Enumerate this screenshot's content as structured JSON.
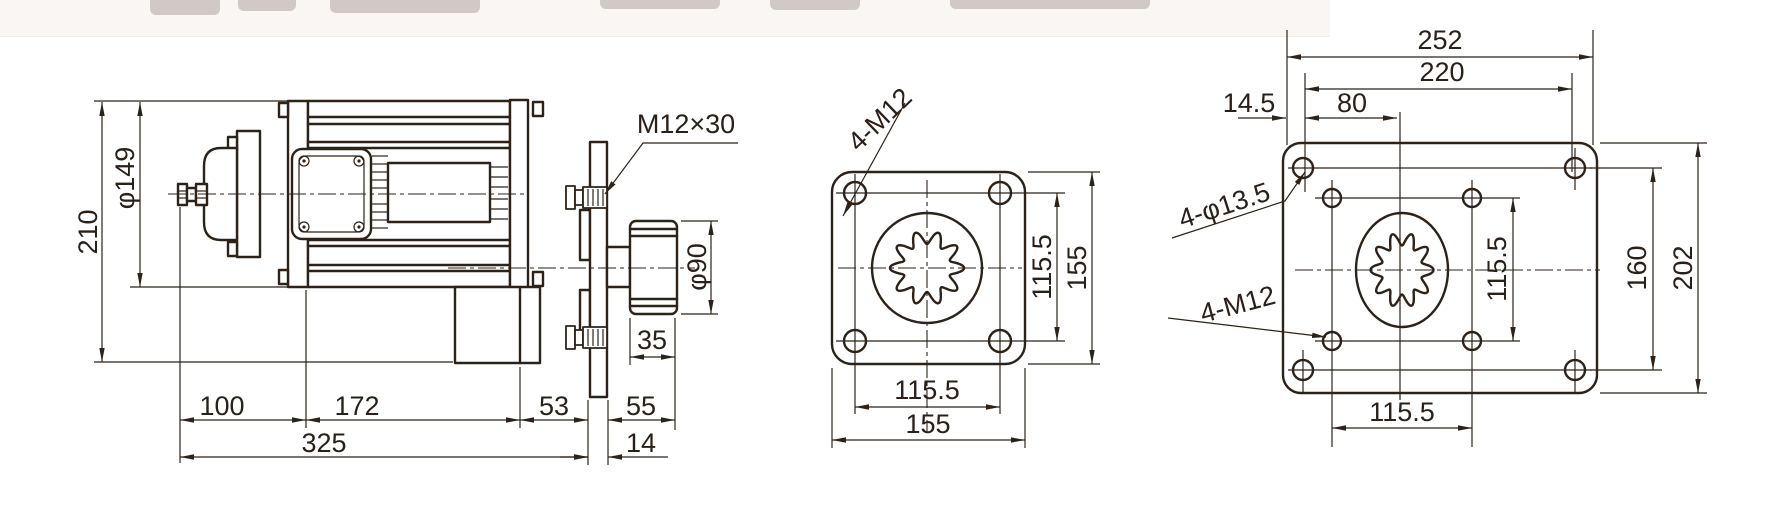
{
  "colors": {
    "line": "#2e2218",
    "background": "#ffffff"
  },
  "side_view": {
    "labels": {
      "overall_height": "210",
      "body_diameter": "φ149",
      "bolt_spec": "M12×30",
      "coupling_diameter": "φ90",
      "coupling_width": "35",
      "front_length": "100",
      "body_length": "172",
      "gear_length": "53",
      "output_length": "55",
      "total_length": "325",
      "flange_thickness": "14"
    }
  },
  "flange_view": {
    "labels": {
      "hole_spec": "4-M12",
      "hole_spacing_vertical": "115.5",
      "overall_height": "155",
      "hole_spacing_horizontal": "115.5",
      "overall_width": "155"
    }
  },
  "plate_view": {
    "labels": {
      "overall_width": "252",
      "outer_hole_spacing_horizontal": "220",
      "edge_to_hole": "14.5",
      "hole_to_center": "80",
      "outer_hole_spec": "4-φ13.5",
      "inner_hole_spec": "4-M12",
      "inner_hole_spacing_vertical": "115.5",
      "outer_hole_spacing_vertical": "160",
      "overall_height": "202",
      "inner_hole_spacing_horizontal": "115.5"
    }
  }
}
